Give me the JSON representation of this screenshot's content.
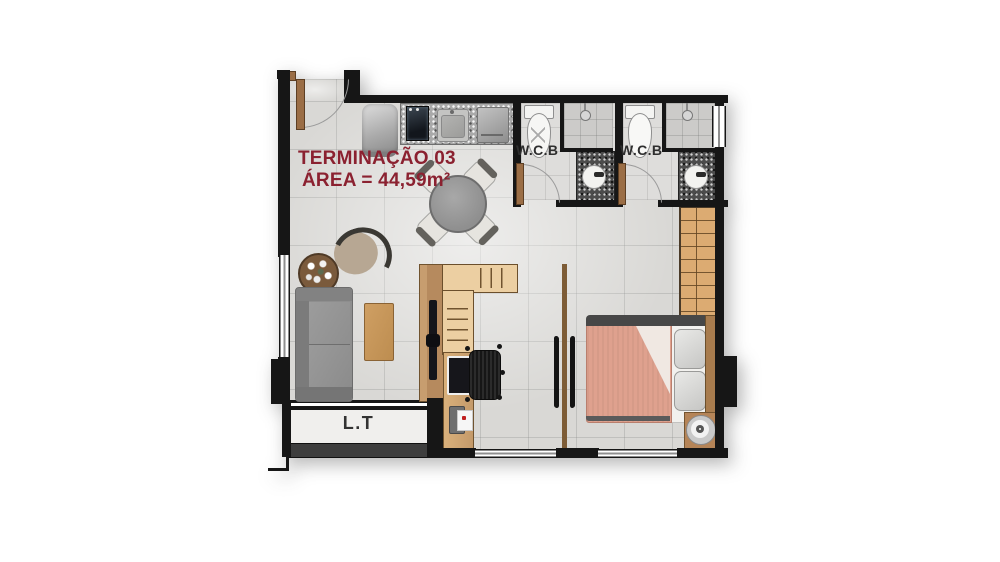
{
  "plan": {
    "title": "TERMINAÇÃO 03",
    "area": "ÁREA = 44,59m²",
    "labels": {
      "wcb1": "W.C.B",
      "wcb2": "W.C.B",
      "lt": "L.T"
    },
    "colors": {
      "wall": "#161616",
      "title_text": "#8b2130",
      "floor_tile": "#d9d8d5",
      "wood_dark": "#b68a5e",
      "wood_light": "#eccfa2",
      "wardrobe_wood": "#dcab72",
      "bed_blanket": "#dfa18e",
      "sofa_gray": "#8e8e8e",
      "granite_dark": "#4c4c4c",
      "granite_light": "#a9a9a9"
    },
    "furniture": [
      "entry-door",
      "water-heater",
      "cooktop",
      "kitchen-sink",
      "kitchen-appliance",
      "dining-table",
      "dining-chair",
      "plant-pot",
      "armchair",
      "sofa",
      "coffee-table",
      "tv-panel",
      "shelving-unit",
      "desk-monitor",
      "office-chair",
      "printer",
      "sliding-door",
      "double-bed",
      "wardrobe",
      "fan",
      "toilet",
      "shower-head",
      "bathroom-sink"
    ]
  }
}
